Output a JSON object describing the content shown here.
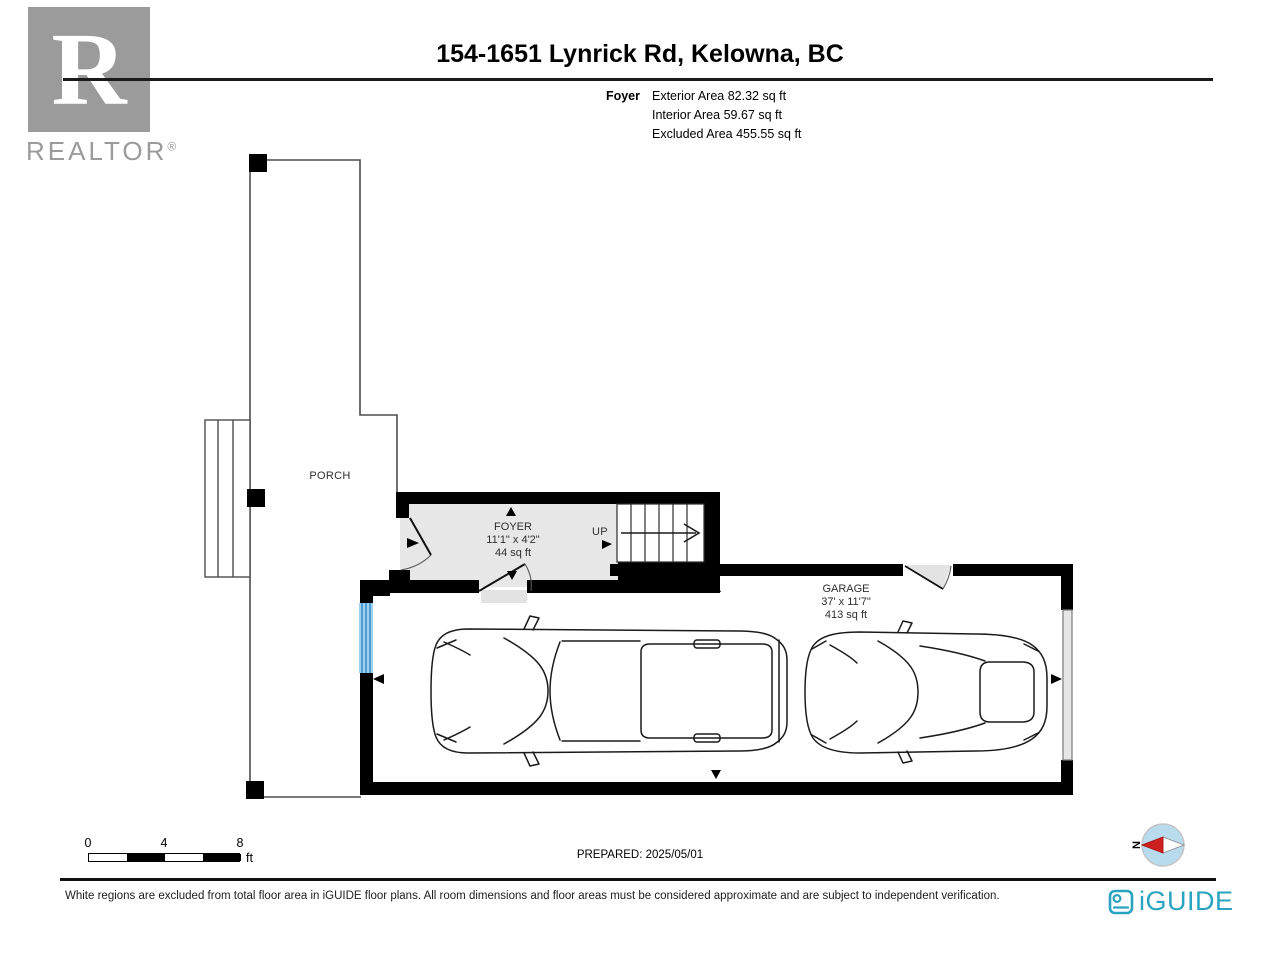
{
  "header": {
    "title": "154-1651 Lynrick Rd, Kelowna, BC"
  },
  "summary": {
    "room": "Foyer",
    "lines": [
      "Exterior Area 82.32 sq ft",
      "Interior Area 59.67 sq ft",
      "Excluded Area 455.55 sq ft"
    ]
  },
  "realtor": {
    "glyph": "R",
    "name": "REALTOR",
    "reg": "®"
  },
  "plan": {
    "porch": {
      "label": "PORCH"
    },
    "foyer": {
      "label": "FOYER",
      "dimensions": "11'1\" x 4'2\"",
      "area": "44 sq ft"
    },
    "stairs": {
      "label": "UP"
    },
    "garage": {
      "label": "GARAGE",
      "dimensions": "37' x 11'7\"",
      "area": "413 sq ft"
    }
  },
  "scale_bar": {
    "ticks": [
      "0",
      "4",
      "8"
    ],
    "unit": "ft"
  },
  "prepared": "PREPARED: 2025/05/01",
  "compass": {
    "label": "N"
  },
  "footer": {
    "disclaimer": "White regions are excluded from total floor area in iGUIDE floor plans. All room dimensions and floor areas must be considered approximate and are subject to independent verification.",
    "brand": "iGUIDE"
  },
  "icons": {
    "compass": "compass-needle-icon",
    "camera": "iguide-camera-icon",
    "window": "window-symbol",
    "garage_door": "garage-door-symbol"
  },
  "colors": {
    "wall": "#000000",
    "foyer_fill": "#e7e7e7",
    "window_blue": "#3f8fcc",
    "window_blue_light": "#9fd0ee",
    "brand_teal": "#2aa3c0",
    "compass_red": "#cf2020",
    "compass_blue": "#b8dcee",
    "logo_grey": "#9b9b9b"
  }
}
